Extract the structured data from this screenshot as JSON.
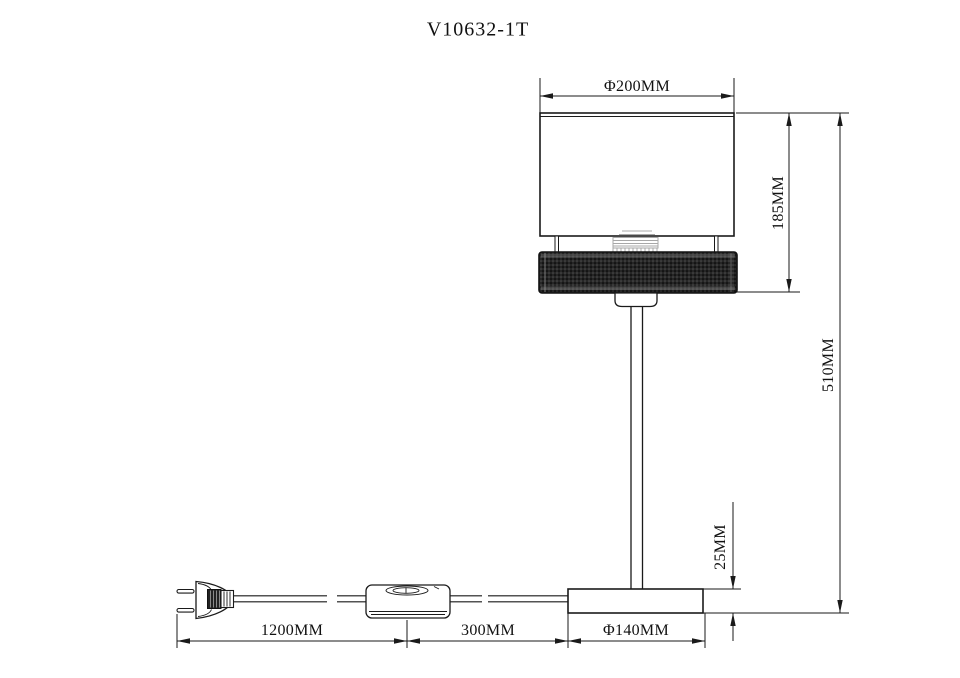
{
  "title": "V10632-1T",
  "drawing": {
    "labels": {
      "shade_diameter": "Φ200MM",
      "shade_height": "185MM",
      "overall_height": "510MM",
      "base_height": "25MM",
      "cord_length": "1200MM",
      "switch_to_base": "300MM",
      "base_diameter": "Φ140MM"
    },
    "colors": {
      "background": "#ffffff",
      "line": "#1a1a1a",
      "band_mesh": "#262626",
      "socket_gray": "#a8a8a8"
    }
  }
}
